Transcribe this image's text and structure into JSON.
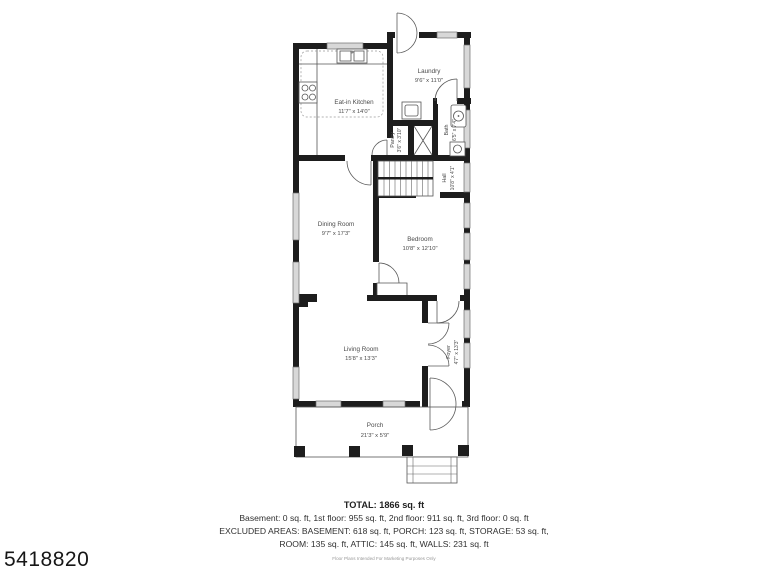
{
  "photo_id": "5418820",
  "rooms": {
    "laundry": {
      "name": "Laundry",
      "dims": "9'6\" x 11'0\""
    },
    "kitchen": {
      "name": "Eat-in Kitchen",
      "dims": "11'7\" x 14'0\""
    },
    "pantry": {
      "name": "Pantry",
      "dims": "3'6\" x 3'10\""
    },
    "bath": {
      "name": "Bath",
      "dims": "6'5\" x 7'4\""
    },
    "hall": {
      "name": "Hall",
      "dims": "10'8\" x 4'1\""
    },
    "dining": {
      "name": "Dining Room",
      "dims": "9'7\" x 17'3\""
    },
    "bedroom": {
      "name": "Bedroom",
      "dims": "10'8\" x 12'10\""
    },
    "living": {
      "name": "Living Room",
      "dims": "15'8\" x 13'3\""
    },
    "foyer": {
      "name": "Foyer",
      "dims": "4'7\" x 13'3\""
    },
    "porch": {
      "name": "Porch",
      "dims": "21'3\" x 5'9\""
    }
  },
  "summary": {
    "total": "TOTAL: 1866 sq. ft",
    "floors": "Basement: 0 sq. ft, 1st floor: 955 sq. ft, 2nd floor: 911 sq. ft, 3rd floor: 0 sq. ft",
    "excluded1": "EXCLUDED AREAS: BASEMENT: 618 sq. ft, PORCH: 123 sq. ft, STORAGE: 53 sq. ft,",
    "excluded2": "ROOM: 135 sq. ft, ATTIC: 145 sq. ft, WALLS: 231 sq. ft",
    "disclaimer": "Floor Plans Intended For Marketing Purposes Only"
  },
  "colors": {
    "wall": "#1d1d1d",
    "window": "#d8d8d8",
    "label": "#4a4a4a"
  }
}
